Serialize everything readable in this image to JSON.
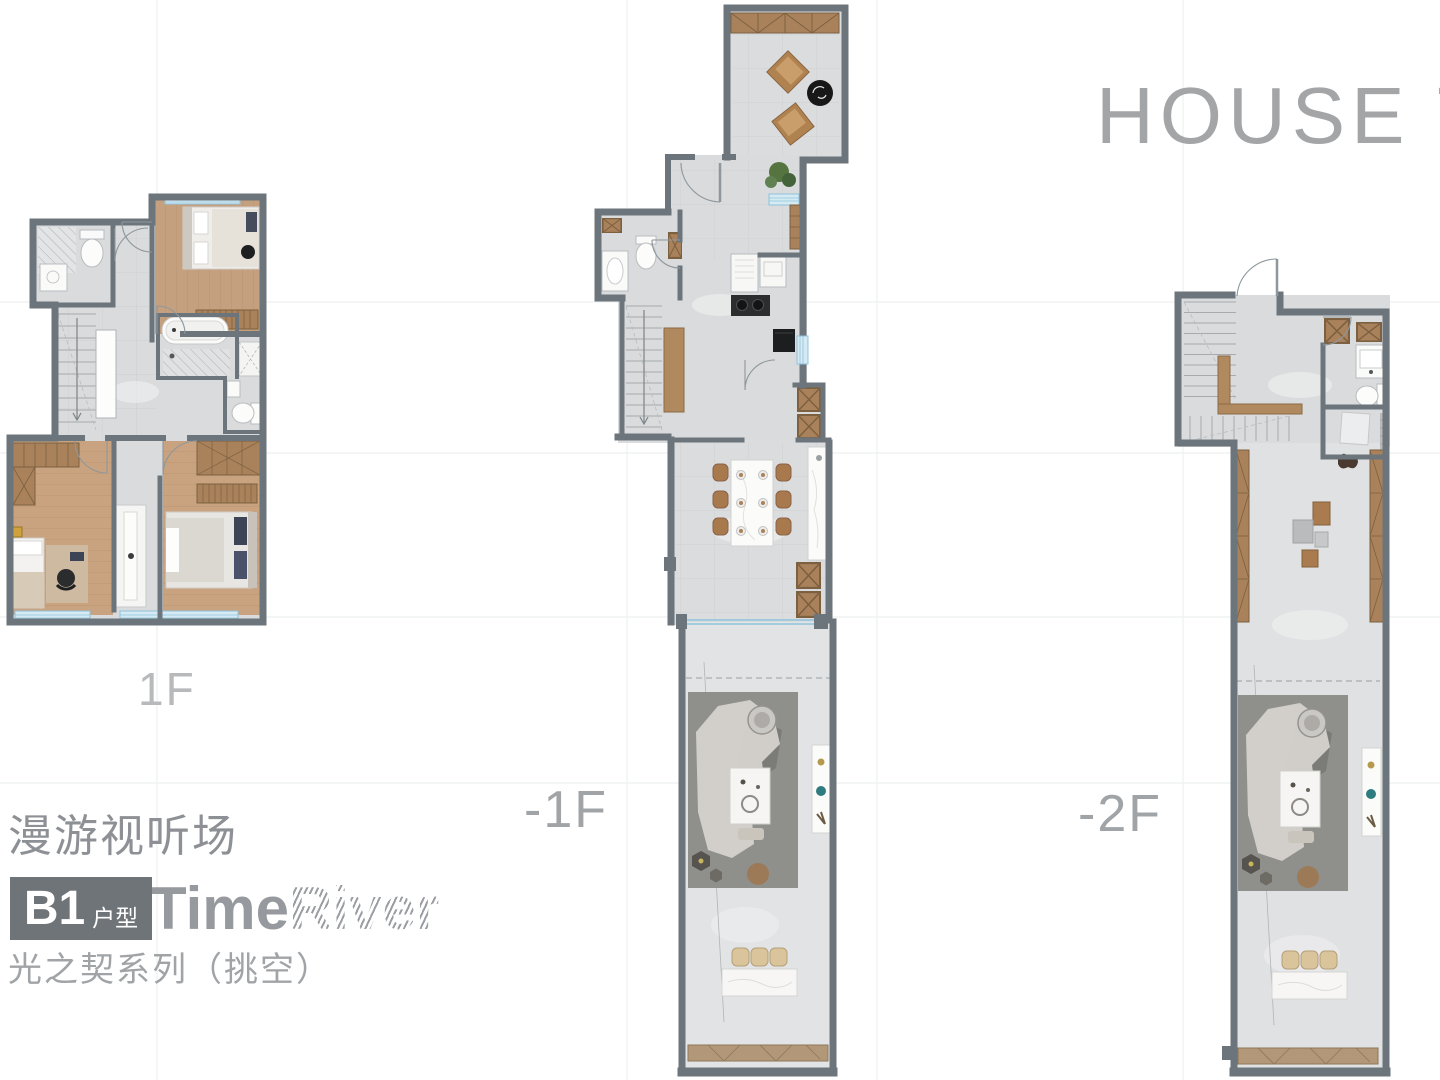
{
  "header": {
    "title": "HOUSE T"
  },
  "floors": [
    {
      "label": "1F"
    },
    {
      "label": "-1F"
    },
    {
      "label": "-2F"
    }
  ],
  "footer": {
    "tagline": "漫游视听场",
    "badge": {
      "code": "B1",
      "suffix": "户型"
    },
    "logo": {
      "part1": "Time",
      "part2": "River"
    },
    "series": "光之契系列（挑空）"
  },
  "colors": {
    "wall": "#6c757b",
    "floor_gray": "#dadcde",
    "wood_floor": "#c5a07e",
    "wood_furniture": "#a9825c",
    "window_blue": "#8fc3dc",
    "title_gray": "#a3a5a7",
    "badge_bg": "#6f7478"
  }
}
